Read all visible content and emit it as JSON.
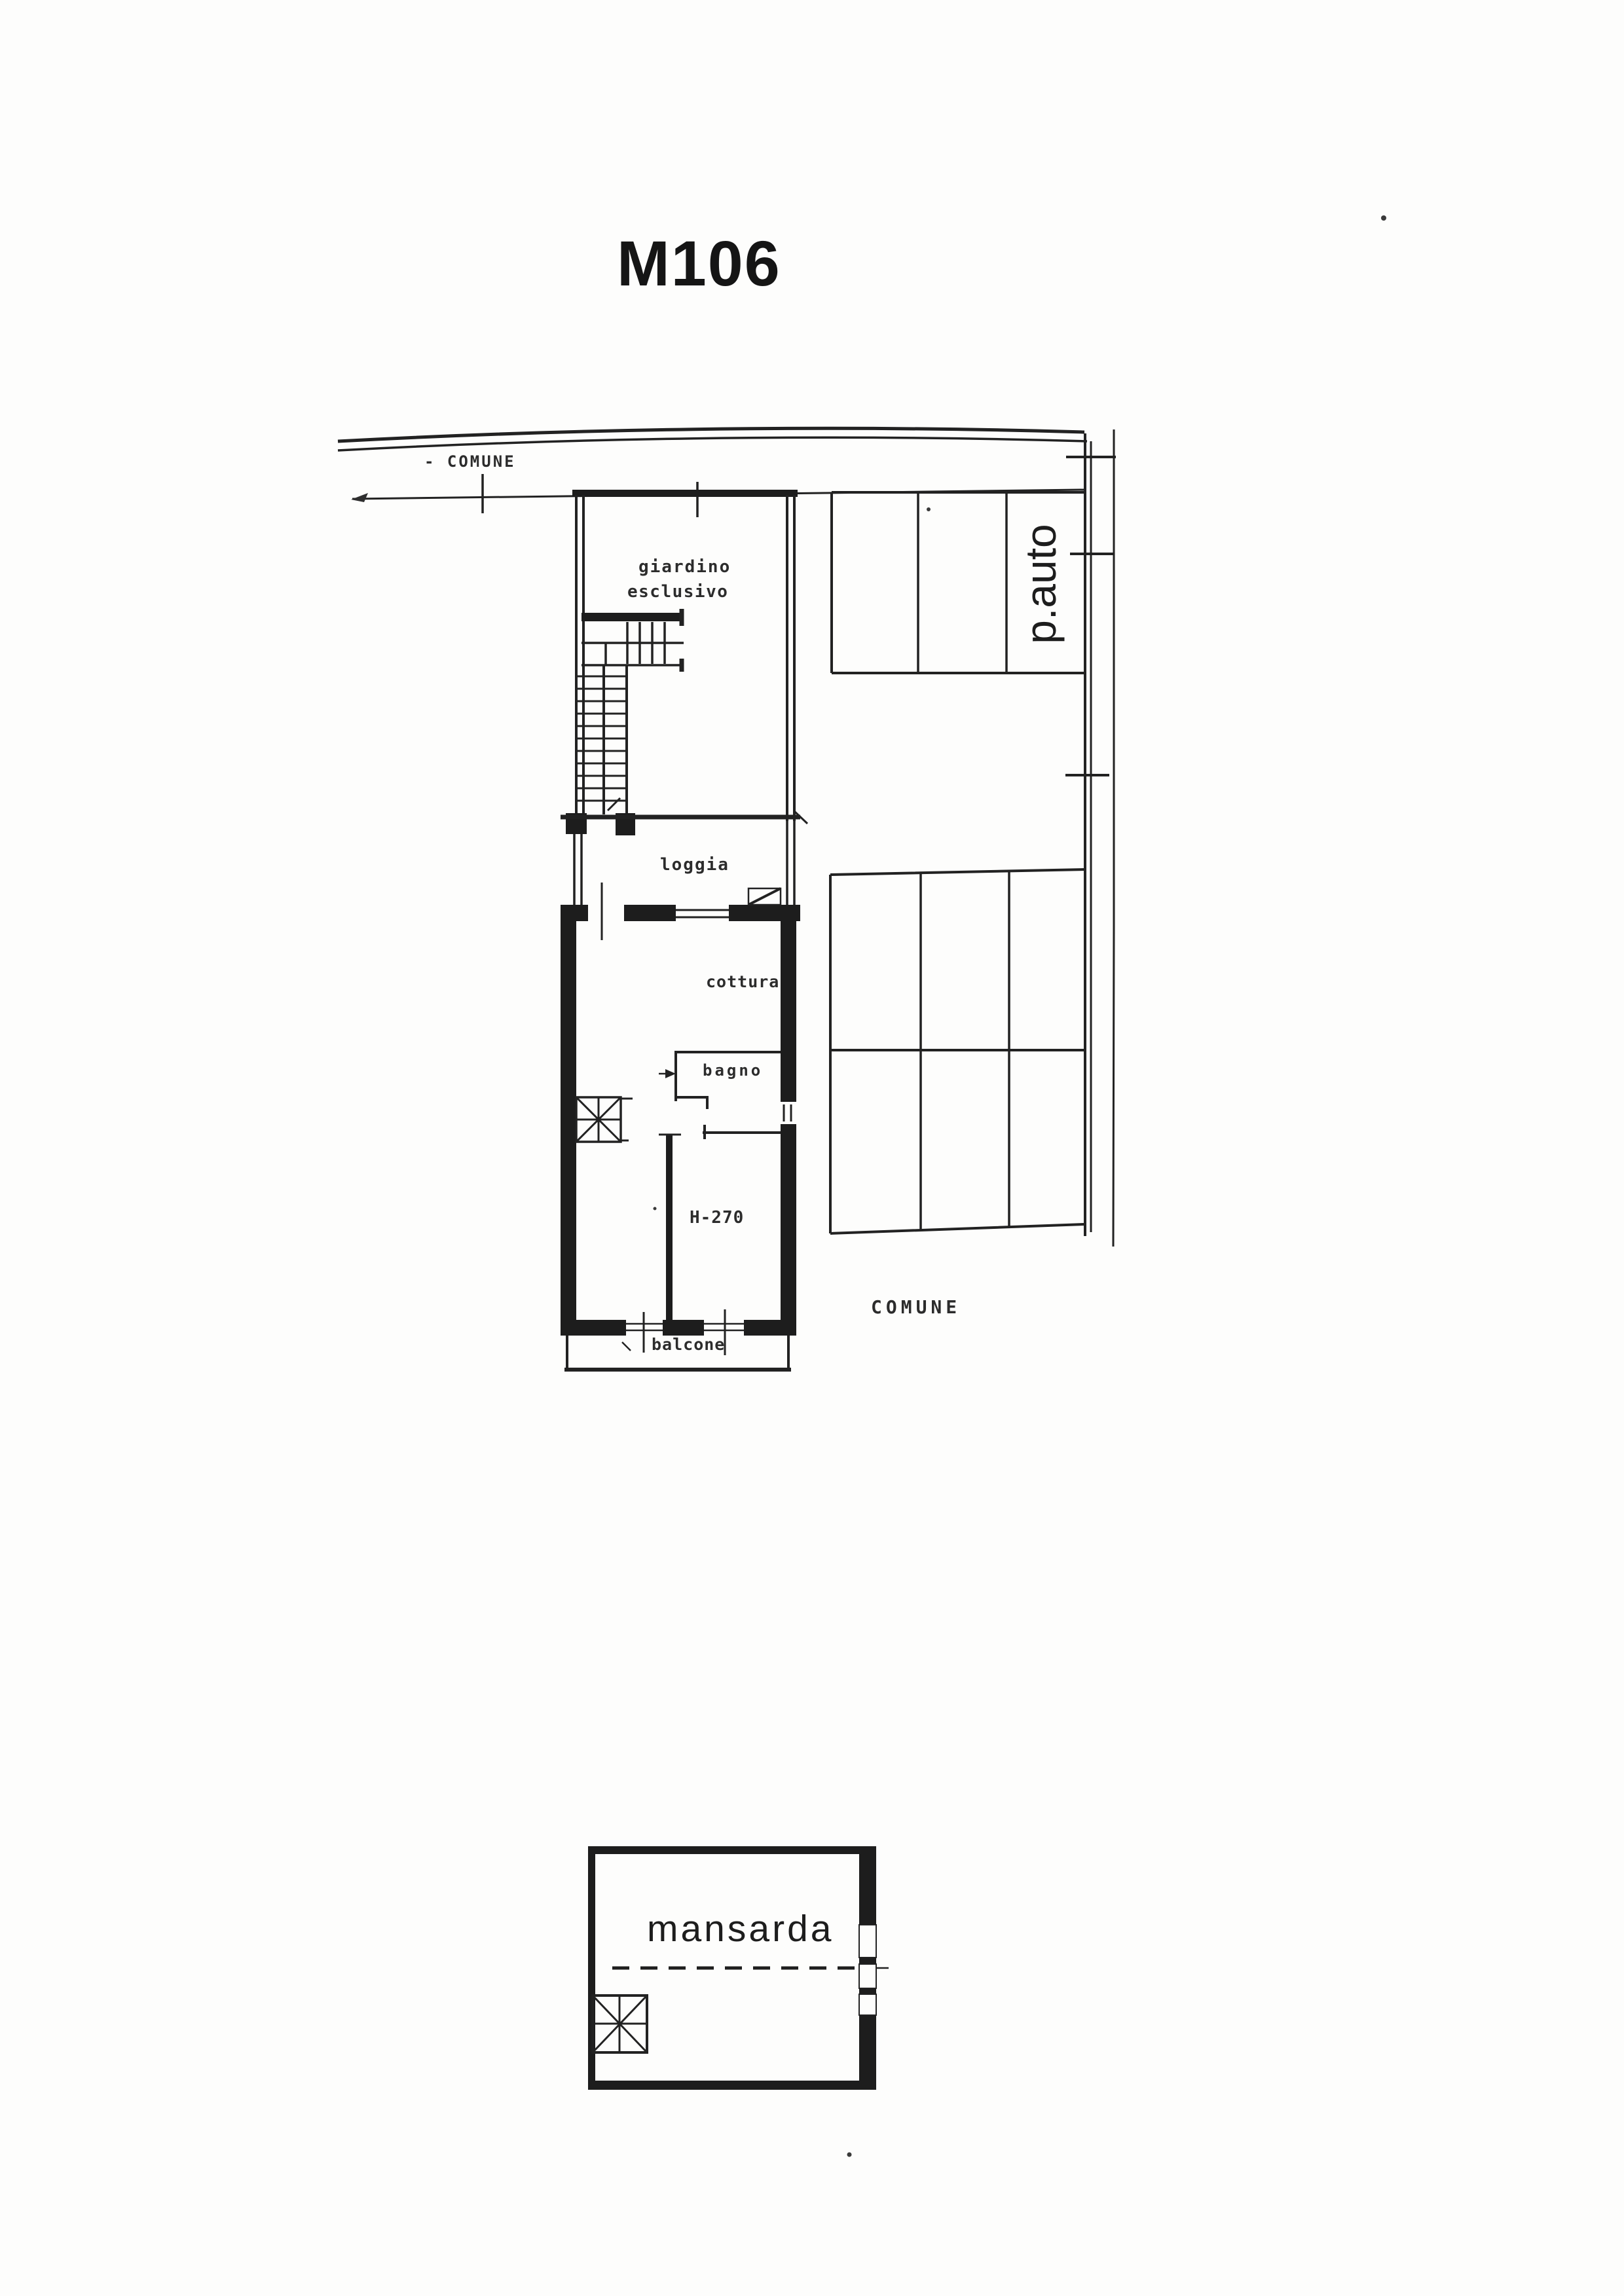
{
  "title": "M106",
  "colors": {
    "ink": "#1c1c1c",
    "paper": "#fdfdfc"
  },
  "site": {
    "boundary_label_top": "- COMUNE",
    "boundary_label_right": "COMUNE"
  },
  "rooms": {
    "garden_line1": "giardino",
    "garden_line2": "esclusivo",
    "parking": "p.auto",
    "loggia": "loggia",
    "kitchen": "cottura",
    "bath": "bagno",
    "height_note": "H-270",
    "balcony": "balcone",
    "attic": "mansarda"
  }
}
